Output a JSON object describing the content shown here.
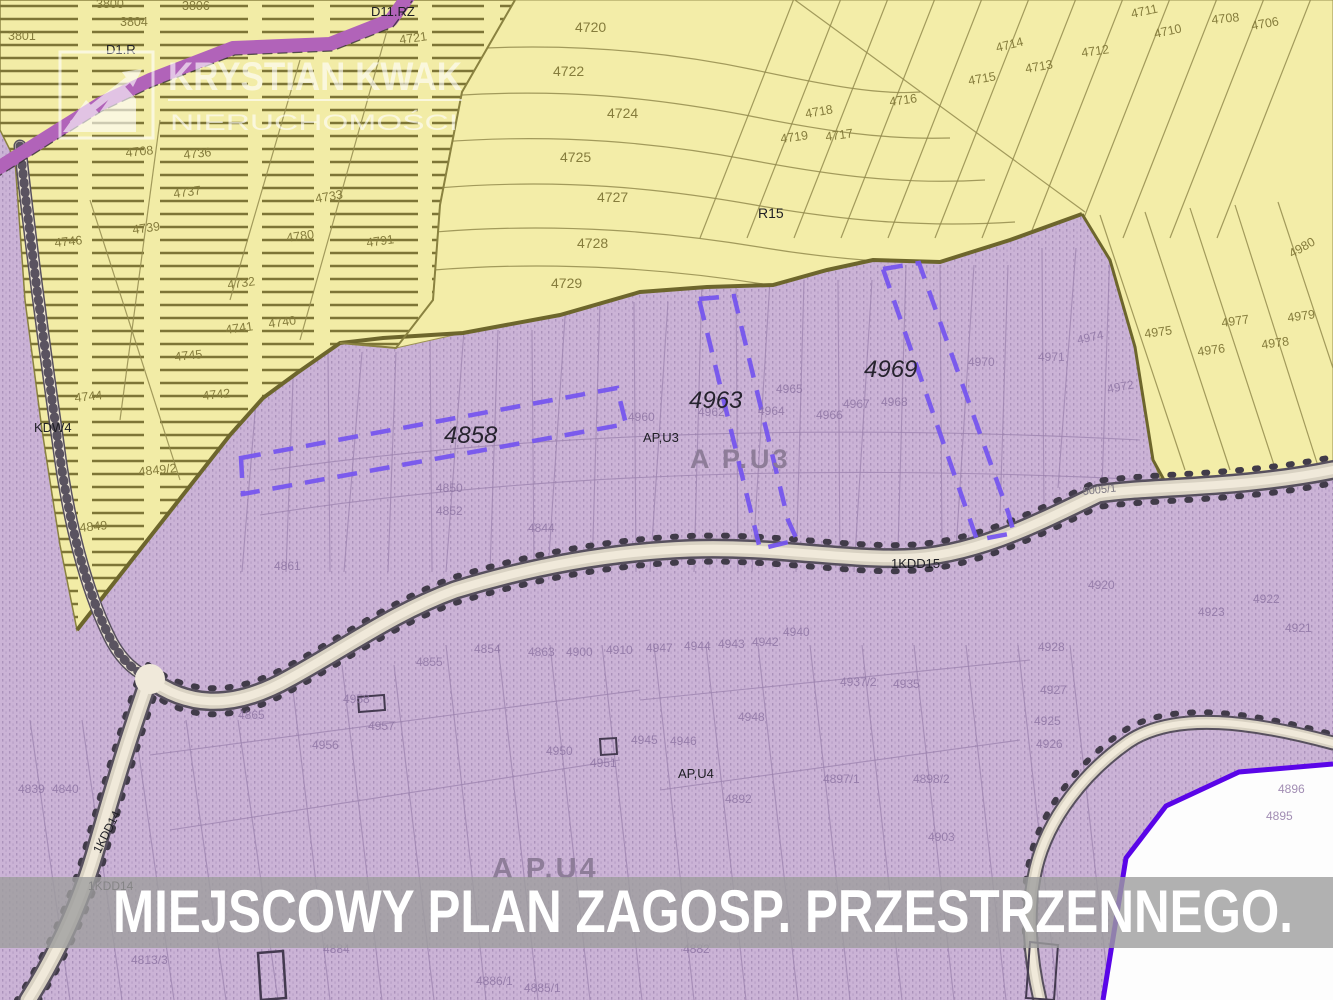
{
  "banner": {
    "text": "MIEJSCOWY PLAN ZAGOSP. PRZESTRZENNEGO."
  },
  "watermark": {
    "title": "KRYSTIAN KWAK",
    "subtitle": "NIERUCHOMOŚCI",
    "logo_icon": "mountain-arrow-logo"
  },
  "highlighted_parcels": [
    "4858",
    "4963",
    "4969"
  ],
  "zone_codes": [
    "D1.R",
    "D11.RZ",
    "R15",
    "KDW4",
    "AP,U3",
    "A P.U3",
    "AP,U4",
    "A P.U4",
    "1KDD15",
    "1KDD14",
    "5005/1"
  ],
  "colors": {
    "yellow_zone": "#f2eca6",
    "purple_zone": "#cbb3d6",
    "purple_dots": "#ab92bb",
    "olive_boundary": "#6d662c",
    "highlight_dash": "#7656ee",
    "magenta_road": "#b163b9",
    "violet_boundary": "#5a05e8",
    "road_fill": "#f0e9da",
    "banner_bg": "#9e9e9e",
    "banner_text": "#ffffff",
    "white_area": "#fdfdfd"
  },
  "map": {
    "labels": [
      {
        "t": "3800",
        "x": 96,
        "y": 8,
        "k": "o"
      },
      {
        "t": "3801",
        "x": 8,
        "y": 40,
        "k": "o"
      },
      {
        "t": "3804",
        "x": 120,
        "y": 26,
        "k": "o"
      },
      {
        "t": "3806",
        "x": 182,
        "y": 10,
        "k": "o"
      },
      {
        "t": "4721",
        "x": 400,
        "y": 44,
        "k": "o",
        "r": -8
      },
      {
        "t": "4720",
        "x": 575,
        "y": 32,
        "k": "o",
        "s": 14
      },
      {
        "t": "4722",
        "x": 553,
        "y": 76,
        "k": "o",
        "s": 14
      },
      {
        "t": "4724",
        "x": 607,
        "y": 118,
        "k": "o",
        "s": 14
      },
      {
        "t": "4725",
        "x": 560,
        "y": 162,
        "k": "o",
        "s": 14
      },
      {
        "t": "4727",
        "x": 597,
        "y": 202,
        "k": "o",
        "s": 14
      },
      {
        "t": "4728",
        "x": 577,
        "y": 248,
        "k": "o",
        "s": 14
      },
      {
        "t": "4729",
        "x": 551,
        "y": 288,
        "k": "o",
        "s": 14
      },
      {
        "t": "4711",
        "x": 1132,
        "y": 18,
        "k": "o",
        "r": -12
      },
      {
        "t": "4710",
        "x": 1155,
        "y": 38,
        "k": "o",
        "r": -12
      },
      {
        "t": "4708",
        "x": 1212,
        "y": 24,
        "k": "o",
        "r": -6
      },
      {
        "t": "4706",
        "x": 1252,
        "y": 30,
        "k": "o",
        "r": -10
      },
      {
        "t": "4712",
        "x": 1082,
        "y": 57,
        "k": "o",
        "r": -8
      },
      {
        "t": "4714",
        "x": 997,
        "y": 52,
        "k": "o",
        "r": -14
      },
      {
        "t": "4713",
        "x": 1026,
        "y": 73,
        "k": "o",
        "r": -10
      },
      {
        "t": "4715",
        "x": 969,
        "y": 85,
        "k": "o",
        "r": -10
      },
      {
        "t": "4716",
        "x": 890,
        "y": 106,
        "k": "o",
        "r": -8
      },
      {
        "t": "4718",
        "x": 806,
        "y": 118,
        "k": "o",
        "r": -10
      },
      {
        "t": "4719",
        "x": 781,
        "y": 143,
        "k": "o",
        "r": -8
      },
      {
        "t": "4717",
        "x": 826,
        "y": 141,
        "k": "o",
        "r": -8
      },
      {
        "t": "4975",
        "x": 1145,
        "y": 338,
        "k": "o",
        "r": -8
      },
      {
        "t": "4977",
        "x": 1222,
        "y": 327,
        "k": "o",
        "r": -8
      },
      {
        "t": "4979",
        "x": 1288,
        "y": 322,
        "k": "o",
        "r": -8
      },
      {
        "t": "4976",
        "x": 1198,
        "y": 356,
        "k": "o",
        "r": -8
      },
      {
        "t": "4978",
        "x": 1262,
        "y": 349,
        "k": "o",
        "r": -8
      },
      {
        "t": "4980",
        "x": 1292,
        "y": 258,
        "k": "o",
        "r": -30
      },
      {
        "t": "4708",
        "x": 126,
        "y": 157,
        "k": "o",
        "r": -6
      },
      {
        "t": "4736",
        "x": 184,
        "y": 159,
        "k": "o",
        "r": -6
      },
      {
        "t": "4737",
        "x": 174,
        "y": 198,
        "k": "o",
        "r": -8
      },
      {
        "t": "4739",
        "x": 133,
        "y": 234,
        "k": "o",
        "r": -8
      },
      {
        "t": "4746",
        "x": 55,
        "y": 247,
        "k": "o",
        "r": -6
      },
      {
        "t": "4733",
        "x": 316,
        "y": 203,
        "k": "o",
        "r": -10
      },
      {
        "t": "4780",
        "x": 287,
        "y": 242,
        "k": "o",
        "r": -8
      },
      {
        "t": "4791",
        "x": 367,
        "y": 247,
        "k": "o",
        "r": -8
      },
      {
        "t": "4732",
        "x": 228,
        "y": 289,
        "k": "o",
        "r": -8
      },
      {
        "t": "4741",
        "x": 226,
        "y": 334,
        "k": "o",
        "r": -8
      },
      {
        "t": "4740",
        "x": 269,
        "y": 328,
        "k": "o",
        "r": -8
      },
      {
        "t": "4745",
        "x": 175,
        "y": 361,
        "k": "o",
        "r": -6
      },
      {
        "t": "4744",
        "x": 75,
        "y": 402,
        "k": "o",
        "r": -6
      },
      {
        "t": "4742",
        "x": 203,
        "y": 400,
        "k": "o",
        "r": -6
      },
      {
        "t": "4849/2",
        "x": 139,
        "y": 476,
        "k": "o",
        "r": -6
      },
      {
        "t": "4849",
        "x": 80,
        "y": 532,
        "k": "o",
        "r": -6
      },
      {
        "t": "4850",
        "x": 436,
        "y": 492,
        "k": "p"
      },
      {
        "t": "4852",
        "x": 436,
        "y": 515,
        "k": "p"
      },
      {
        "t": "4861",
        "x": 274,
        "y": 570,
        "k": "p"
      },
      {
        "t": "4844",
        "x": 528,
        "y": 532,
        "k": "p"
      },
      {
        "t": "4865",
        "x": 238,
        "y": 719,
        "k": "p"
      },
      {
        "t": "4855",
        "x": 416,
        "y": 666,
        "k": "p"
      },
      {
        "t": "4854",
        "x": 474,
        "y": 653,
        "k": "p"
      },
      {
        "t": "4863",
        "x": 528,
        "y": 656,
        "k": "p"
      },
      {
        "t": "4900",
        "x": 566,
        "y": 656,
        "k": "p"
      },
      {
        "t": "4910",
        "x": 606,
        "y": 654,
        "k": "p"
      },
      {
        "t": "4947",
        "x": 646,
        "y": 652,
        "k": "p"
      },
      {
        "t": "4944",
        "x": 684,
        "y": 650,
        "k": "p"
      },
      {
        "t": "4943",
        "x": 718,
        "y": 648,
        "k": "p"
      },
      {
        "t": "4942",
        "x": 752,
        "y": 646,
        "k": "p"
      },
      {
        "t": "4940",
        "x": 783,
        "y": 636,
        "k": "p"
      },
      {
        "t": "4937/2",
        "x": 840,
        "y": 686,
        "k": "p"
      },
      {
        "t": "4935",
        "x": 893,
        "y": 688,
        "k": "p"
      },
      {
        "t": "4928",
        "x": 1038,
        "y": 651,
        "k": "p"
      },
      {
        "t": "4927",
        "x": 1040,
        "y": 694,
        "k": "p"
      },
      {
        "t": "4925",
        "x": 1034,
        "y": 725,
        "k": "p"
      },
      {
        "t": "4926",
        "x": 1036,
        "y": 748,
        "k": "p"
      },
      {
        "t": "4920",
        "x": 1088,
        "y": 589,
        "k": "p"
      },
      {
        "t": "4923",
        "x": 1198,
        "y": 616,
        "k": "p"
      },
      {
        "t": "4922",
        "x": 1253,
        "y": 603,
        "k": "p"
      },
      {
        "t": "4921",
        "x": 1285,
        "y": 632,
        "k": "p"
      },
      {
        "t": "4958",
        "x": 343,
        "y": 703,
        "k": "p"
      },
      {
        "t": "4957",
        "x": 368,
        "y": 730,
        "k": "p"
      },
      {
        "t": "4956",
        "x": 312,
        "y": 749,
        "k": "p"
      },
      {
        "t": "4950",
        "x": 546,
        "y": 755,
        "k": "p"
      },
      {
        "t": "4951",
        "x": 590,
        "y": 767,
        "k": "p"
      },
      {
        "t": "4945",
        "x": 631,
        "y": 744,
        "k": "p"
      },
      {
        "t": "4946",
        "x": 670,
        "y": 745,
        "k": "p"
      },
      {
        "t": "4948",
        "x": 738,
        "y": 721,
        "k": "p"
      },
      {
        "t": "4960",
        "x": 628,
        "y": 421,
        "k": "p"
      },
      {
        "t": "4962",
        "x": 698,
        "y": 416,
        "k": "p"
      },
      {
        "t": "4964",
        "x": 758,
        "y": 415,
        "k": "p"
      },
      {
        "t": "4965",
        "x": 776,
        "y": 393,
        "k": "p"
      },
      {
        "t": "4966",
        "x": 816,
        "y": 419,
        "k": "p"
      },
      {
        "t": "4967",
        "x": 843,
        "y": 408,
        "k": "p"
      },
      {
        "t": "4968",
        "x": 881,
        "y": 406,
        "k": "p"
      },
      {
        "t": "4970",
        "x": 968,
        "y": 366,
        "k": "p"
      },
      {
        "t": "4971",
        "x": 1038,
        "y": 361,
        "k": "p"
      },
      {
        "t": "4974",
        "x": 1078,
        "y": 344,
        "k": "p",
        "r": -12
      },
      {
        "t": "4972",
        "x": 1108,
        "y": 393,
        "k": "p",
        "r": -10
      },
      {
        "t": "4898/2",
        "x": 913,
        "y": 783,
        "k": "p"
      },
      {
        "t": "4897/1",
        "x": 823,
        "y": 783,
        "k": "p"
      },
      {
        "t": "4892",
        "x": 725,
        "y": 803,
        "k": "p"
      },
      {
        "t": "4903",
        "x": 928,
        "y": 841,
        "k": "p"
      },
      {
        "t": "4896",
        "x": 1278,
        "y": 793,
        "k": "p"
      },
      {
        "t": "4895",
        "x": 1266,
        "y": 820,
        "k": "p"
      },
      {
        "t": "4839",
        "x": 18,
        "y": 793,
        "k": "p"
      },
      {
        "t": "4840",
        "x": 52,
        "y": 793,
        "k": "p"
      },
      {
        "t": "4813/3",
        "x": 131,
        "y": 964,
        "k": "p"
      },
      {
        "t": "4884",
        "x": 323,
        "y": 953,
        "k": "p"
      },
      {
        "t": "4886/1",
        "x": 476,
        "y": 985,
        "k": "p"
      },
      {
        "t": "4885/1",
        "x": 524,
        "y": 992,
        "k": "p"
      },
      {
        "t": "4882",
        "x": 683,
        "y": 953,
        "k": "p"
      },
      {
        "t": "D1.R",
        "x": 106,
        "y": 54,
        "k": "b"
      },
      {
        "t": "D11.RZ",
        "x": 371,
        "y": 16,
        "k": "b"
      },
      {
        "t": "R15",
        "x": 758,
        "y": 218,
        "k": "b",
        "s": 14
      },
      {
        "t": "KDW4",
        "x": 34,
        "y": 432,
        "k": "b"
      },
      {
        "t": "AP,U3",
        "x": 643,
        "y": 442,
        "k": "b"
      },
      {
        "t": "AP,U4",
        "x": 678,
        "y": 778,
        "k": "b"
      },
      {
        "t": "1KDD15",
        "x": 891,
        "y": 568,
        "k": "b"
      },
      {
        "t": "1KDD14",
        "x": 88,
        "y": 890,
        "k": "b",
        "s": 12
      },
      {
        "t": "1KDD14",
        "x": 100,
        "y": 854,
        "k": "b",
        "s": 12,
        "r": -63
      },
      {
        "t": "5005/1",
        "x": 1083,
        "y": 495,
        "k": "g",
        "r": -6
      },
      {
        "t": "A P.U3",
        "x": 690,
        "y": 468,
        "k": "big",
        "s": 27
      },
      {
        "t": "A P.U4",
        "x": 492,
        "y": 878,
        "k": "big",
        "s": 29
      },
      {
        "t": "4858",
        "x": 444,
        "y": 443,
        "k": "hl",
        "s": 24
      },
      {
        "t": "4963",
        "x": 689,
        "y": 408,
        "k": "hl",
        "s": 24
      },
      {
        "t": "4969",
        "x": 864,
        "y": 377,
        "k": "hl",
        "s": 24
      }
    ]
  }
}
